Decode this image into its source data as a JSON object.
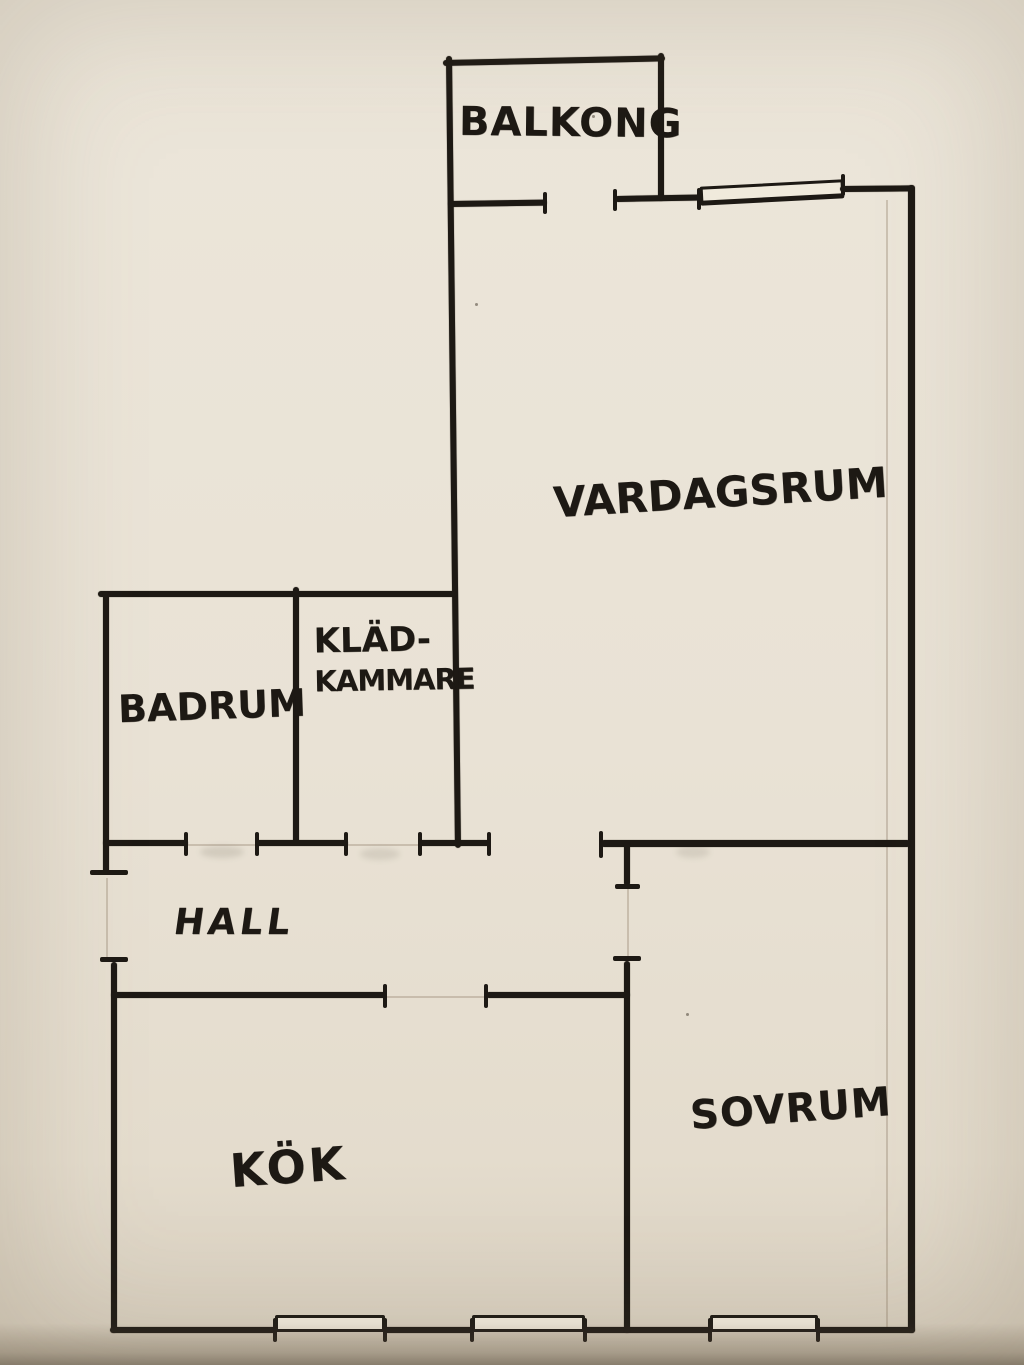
{
  "floorplan": {
    "type": "hand-drawn apartment floor plan",
    "colors": {
      "paper": "#e9e2d5",
      "ink": "#1d1914",
      "pencil": "#8a7560"
    },
    "rooms": {
      "balkong": {
        "label": "BALKONG"
      },
      "vardagsrum": {
        "label": "VARDAGSRUM"
      },
      "badrum": {
        "label": "BADRUM"
      },
      "kladkammare": {
        "line1": "KLÄD-",
        "line2": "KAMMARE"
      },
      "hall": {
        "label": "HALL"
      },
      "kok": {
        "label": "KÖK"
      },
      "sovrum": {
        "label": "SOVRUM"
      }
    }
  }
}
